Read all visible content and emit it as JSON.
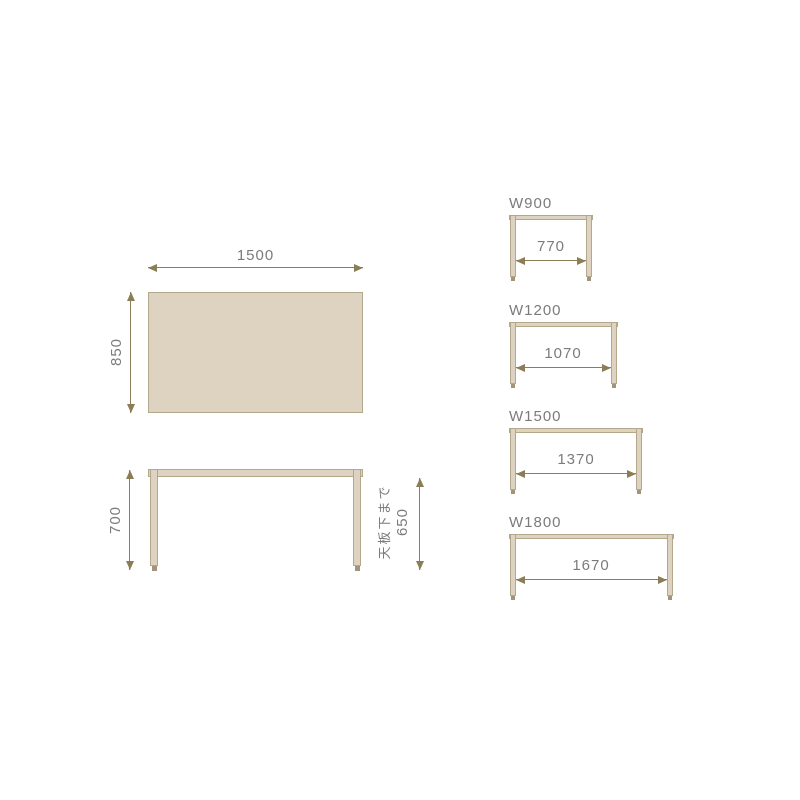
{
  "colors": {
    "background": "#ffffff",
    "surface": "#ded3c1",
    "outline": "#b4a88c",
    "arrow": "#8b7e57",
    "foot": "#a2947b",
    "text": "#7b7b7b"
  },
  "top_view": {
    "width": "1500",
    "depth": "850"
  },
  "front_view": {
    "height": "700",
    "under_tabletop_note": "天板下まで",
    "under_tabletop_value": "650"
  },
  "variants": [
    {
      "label": "W900",
      "inner_width": "770"
    },
    {
      "label": "W1200",
      "inner_width": "1070"
    },
    {
      "label": "W1500",
      "inner_width": "1370"
    },
    {
      "label": "W1800",
      "inner_width": "1670"
    }
  ]
}
